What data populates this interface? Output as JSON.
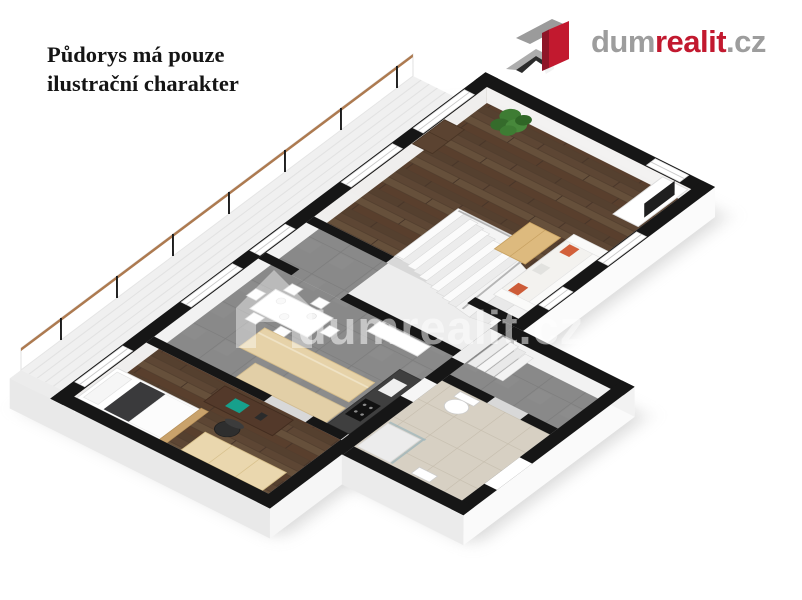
{
  "disclaimer": {
    "line1": "Půdorys má pouze",
    "line2": "ilustrační charakter"
  },
  "logo": {
    "dum": "dum",
    "realit": "realit",
    "tld": ".cz",
    "brand_red": "#c2192f",
    "brand_gray": "#9d9d9d"
  },
  "watermark": {
    "text": "dumrealit.cz"
  },
  "floorplan": {
    "style": "3d-isometric-render",
    "rooms": [
      {
        "name": "balcony-terrace",
        "floor": "white-deck"
      },
      {
        "name": "living-room",
        "floor": "dark-wood"
      },
      {
        "name": "hallway",
        "floor": "gray-tile"
      },
      {
        "name": "kitchen-dining",
        "floor": "gray-tile"
      },
      {
        "name": "bedroom-office",
        "floor": "dark-wood"
      },
      {
        "name": "bathroom",
        "floor": "beige-tile"
      },
      {
        "name": "storage-room",
        "floor": "gray-tile"
      },
      {
        "name": "staircase",
        "floor": "white"
      }
    ],
    "furniture": [
      "plant",
      "cabinet",
      "tv-unit",
      "sofa",
      "coffee-table",
      "dining-table",
      "chairs",
      "kitchen-island",
      "cooktop-counter",
      "tall-cabinet",
      "bed",
      "desk",
      "laptop",
      "office-chair",
      "wardrobe",
      "toilet",
      "shower"
    ],
    "colors": {
      "wall_top": "#161616",
      "wall_face": "#fdfdfd",
      "wood_floor": "#5d4634",
      "gray_floor": "#898989",
      "beige_floor": "#d7d0c3",
      "light_wood": "#e6d2a8",
      "dark_wood": "#53392a"
    }
  }
}
